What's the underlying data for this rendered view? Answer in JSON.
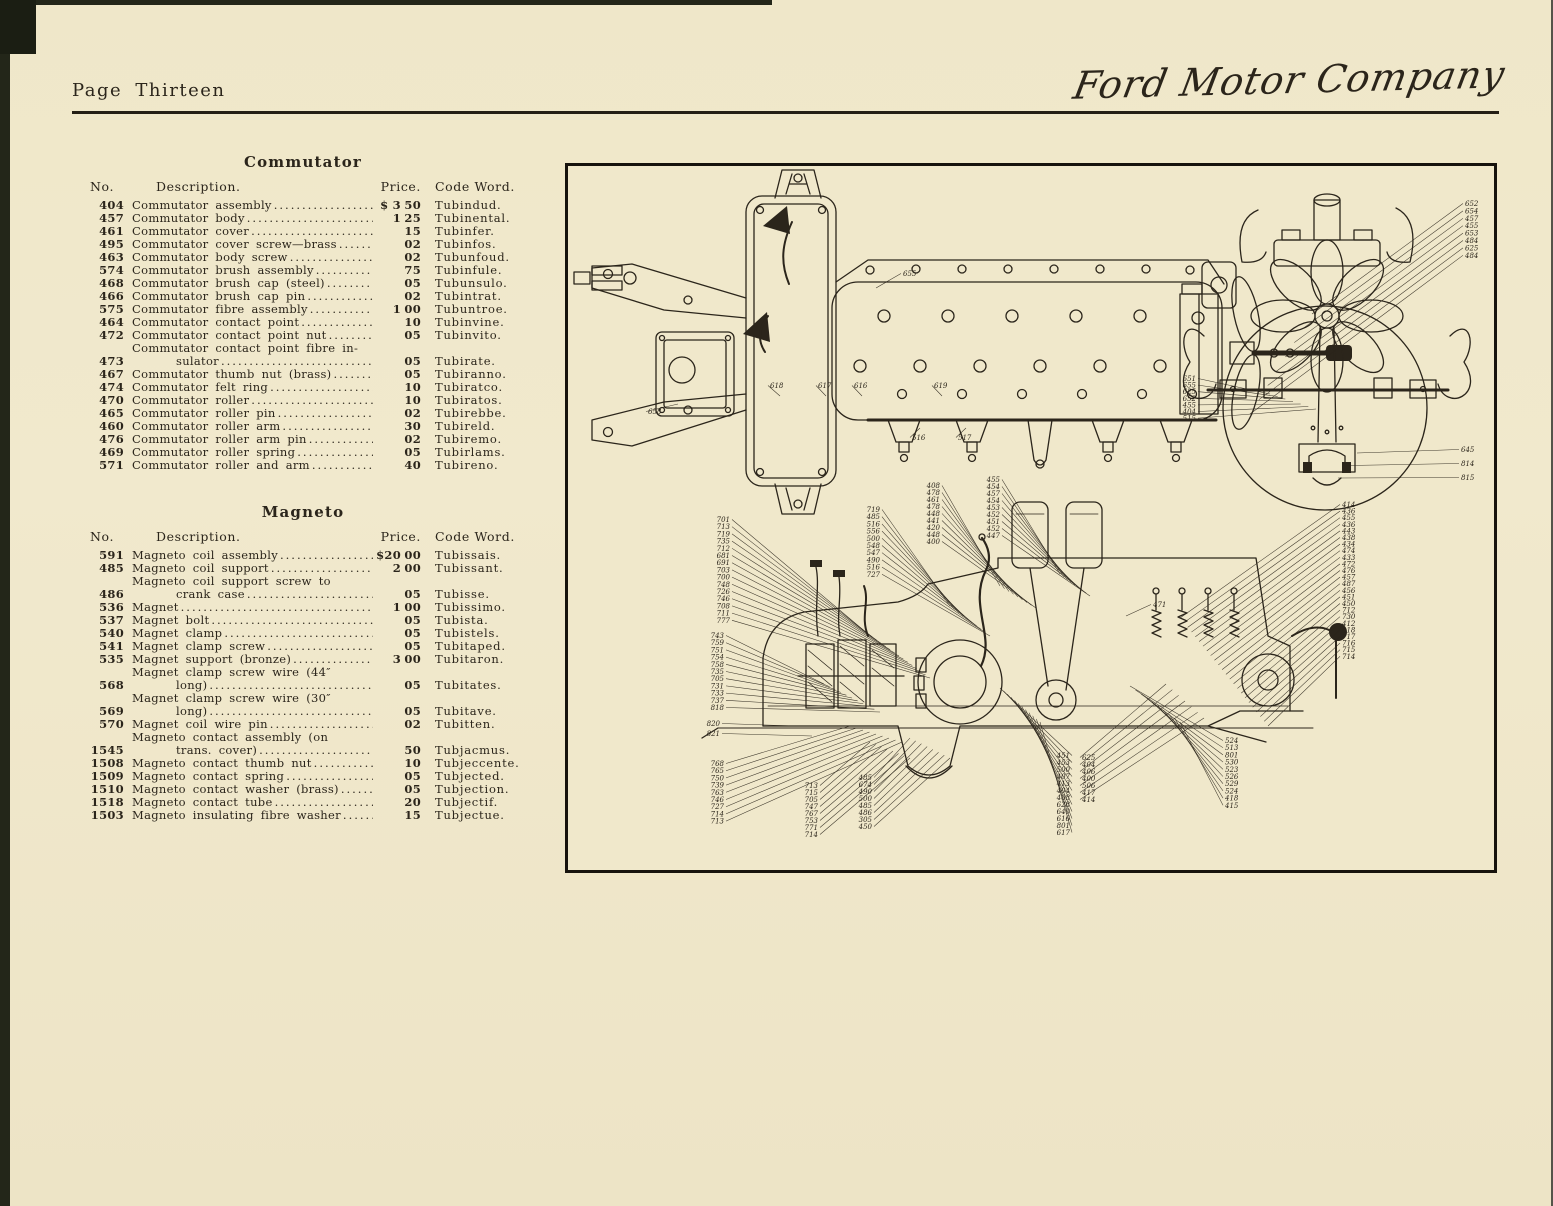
{
  "page": {
    "label": "Page Thirteen",
    "brand": "Ford Motor Company"
  },
  "commutator": {
    "title": "Commutator",
    "columns": {
      "no": "No.",
      "desc": "Description.",
      "price": "Price.",
      "code": "Code Word."
    },
    "rows": [
      {
        "no": "404",
        "desc": "Commutator assembly",
        "pd": "$ 3",
        "pc": "50",
        "code": "Tubindud."
      },
      {
        "no": "457",
        "desc": "Commutator body",
        "pd": "1",
        "pc": "25",
        "code": "Tubinental."
      },
      {
        "no": "461",
        "desc": "Commutator cover",
        "pd": "",
        "pc": "15",
        "code": "Tubinfer."
      },
      {
        "no": "495",
        "desc": "Commutator cover screw—brass",
        "pd": "",
        "pc": "02",
        "code": "Tubinfos."
      },
      {
        "no": "463",
        "desc": "Commutator body screw",
        "pd": "",
        "pc": "02",
        "code": "Tubunfoud."
      },
      {
        "no": "574",
        "desc": "Commutator brush assembly",
        "pd": "",
        "pc": "75",
        "code": "Tubinfule."
      },
      {
        "no": "468",
        "desc": "Commutator brush cap (steel)",
        "pd": "",
        "pc": "05",
        "code": "Tubunsulo."
      },
      {
        "no": "466",
        "desc": "Commutator brush cap pin",
        "pd": "",
        "pc": "02",
        "code": "Tubintrat."
      },
      {
        "no": "575",
        "desc": "Commutator fibre assembly",
        "pd": "1",
        "pc": "00",
        "code": "Tubuntroe."
      },
      {
        "no": "464",
        "desc": "Commutator contact point",
        "pd": "",
        "pc": "10",
        "code": "Tubinvine."
      },
      {
        "no": "472",
        "desc": "Commutator contact point nut",
        "pd": "",
        "pc": "05",
        "code": "Tubinvito."
      },
      {
        "no": "473",
        "desc": "Commutator contact point fibre in-",
        "desc2": "sulator",
        "pd": "",
        "pc": "05",
        "code": "Tubirate."
      },
      {
        "no": "467",
        "desc": "Commutator thumb nut (brass)",
        "pd": "",
        "pc": "05",
        "code": "Tubiranno."
      },
      {
        "no": "474",
        "desc": "Commutator felt ring",
        "pd": "",
        "pc": "10",
        "code": "Tubiratco."
      },
      {
        "no": "470",
        "desc": "Commutator roller",
        "pd": "",
        "pc": "10",
        "code": "Tubiratos."
      },
      {
        "no": "465",
        "desc": "Commutator roller pin",
        "pd": "",
        "pc": "02",
        "code": "Tubirebbe."
      },
      {
        "no": "460",
        "desc": "Commutator roller arm",
        "pd": "",
        "pc": "30",
        "code": "Tubireld."
      },
      {
        "no": "476",
        "desc": "Commutator roller arm pin",
        "pd": "",
        "pc": "02",
        "code": "Tubiremo."
      },
      {
        "no": "469",
        "desc": "Commutator roller spring",
        "pd": "",
        "pc": "05",
        "code": "Tubirlams."
      },
      {
        "no": "571",
        "desc": "Commutator roller and arm",
        "pd": "",
        "pc": "40",
        "code": "Tubireno."
      }
    ]
  },
  "magneto": {
    "title": "Magneto",
    "columns": {
      "no": "No.",
      "desc": "Description.",
      "price": "Price.",
      "code": "Code Word."
    },
    "rows": [
      {
        "no": "591",
        "desc": "Magneto coil assembly",
        "pd": "$20",
        "pc": "00",
        "code": "Tubissais."
      },
      {
        "no": "485",
        "desc": "Magneto coil support",
        "pd": "2",
        "pc": "00",
        "code": "Tubissant."
      },
      {
        "no": "486",
        "desc": "Magneto coil support screw to",
        "desc2": "crank case",
        "pd": "",
        "pc": "05",
        "code": "Tubisse."
      },
      {
        "no": "536",
        "desc": "Magnet",
        "pd": "1",
        "pc": "00",
        "code": "Tubissimo."
      },
      {
        "no": "537",
        "desc": "Magnet bolt",
        "pd": "",
        "pc": "05",
        "code": "Tubista."
      },
      {
        "no": "540",
        "desc": "Magnet clamp",
        "pd": "",
        "pc": "05",
        "code": "Tubistels."
      },
      {
        "no": "541",
        "desc": "Magnet clamp screw",
        "pd": "",
        "pc": "05",
        "code": "Tubitaped."
      },
      {
        "no": "535",
        "desc": "Magnet support (bronze)",
        "pd": "3",
        "pc": "00",
        "code": "Tubitaron."
      },
      {
        "no": "568",
        "desc": "Magnet clamp screw wire (44″",
        "desc2": "long)",
        "pd": "",
        "pc": "05",
        "code": "Tubitates."
      },
      {
        "no": "569",
        "desc": "Magnet clamp screw wire (30″",
        "desc2": "long)",
        "pd": "",
        "pc": "05",
        "code": "Tubitave."
      },
      {
        "no": "570",
        "desc": "Magnet coil wire pin",
        "pd": "",
        "pc": "02",
        "code": "Tubitten."
      },
      {
        "no": "1545",
        "desc": "Magneto contact assembly (on",
        "desc2": "trans. cover)",
        "pd": "",
        "pc": "50",
        "code": "Tubjacmus."
      },
      {
        "no": "1508",
        "desc": "Magneto contact thumb nut",
        "pd": "",
        "pc": "10",
        "code": "Tubjeccente."
      },
      {
        "no": "1509",
        "desc": "Magneto contact spring",
        "pd": "",
        "pc": "05",
        "code": "Tubjected."
      },
      {
        "no": "1510",
        "desc": "Magneto contact washer (brass)",
        "pd": "",
        "pc": "05",
        "code": "Tubjection."
      },
      {
        "no": "1518",
        "desc": "Magneto contact tube",
        "pd": "",
        "pc": "20",
        "code": "Tubjectif."
      },
      {
        "no": "1503",
        "desc": "Magneto insulating fibre washer",
        "pd": "",
        "pc": "15",
        "code": "Tubjectue."
      }
    ]
  },
  "diagram": {
    "singles": [
      {
        "t": "655",
        "x": 335,
        "y": 110,
        "lx": 308,
        "ly": 122
      },
      {
        "t": "658",
        "x": 80,
        "y": 248,
        "lx": 110,
        "ly": 238
      },
      {
        "t": "618",
        "x": 202,
        "y": 222,
        "lx": 212,
        "ly": 230
      },
      {
        "t": "617",
        "x": 250,
        "y": 222,
        "lx": 258,
        "ly": 230
      },
      {
        "t": "616",
        "x": 286,
        "y": 222,
        "lx": 294,
        "ly": 230
      },
      {
        "t": "619",
        "x": 366,
        "y": 222,
        "lx": 374,
        "ly": 230
      },
      {
        "t": "516",
        "x": 344,
        "y": 274,
        "lx": 352,
        "ly": 262
      },
      {
        "t": "517",
        "x": 390,
        "y": 274,
        "lx": 398,
        "ly": 262
      },
      {
        "t": "471",
        "x": 585,
        "y": 441,
        "lx": 558,
        "ly": 450
      }
    ],
    "clusters": [
      {
        "name": "front-right-labels",
        "x": 897,
        "y0": 40,
        "dy": 7.4,
        "anchor": "start",
        "items": [
          "652",
          "654",
          "457",
          "455",
          "653",
          "484",
          "625",
          "484"
        ],
        "fan": [
          744,
          148,
          682,
          248
        ]
      },
      {
        "name": "front-left-labels",
        "x": 628,
        "y0": 215,
        "dy": 6.6,
        "anchor": "end",
        "items": [
          "651",
          "655",
          "625",
          "652",
          "455",
          "404",
          "515"
        ],
        "fan": [
          702,
          228,
          748,
          243
        ]
      },
      {
        "name": "front-bottom-labels",
        "x": 893,
        "y0": 286,
        "dy": 14,
        "anchor": "start",
        "items": [
          "645",
          "814",
          "815"
        ],
        "fan": [
          789,
          287,
          770,
          312
        ]
      },
      {
        "name": "right-column-labels",
        "x": 774,
        "y0": 341,
        "dy": 6.6,
        "fs": 6.2,
        "anchor": "start",
        "items": [
          "414",
          "436",
          "455",
          "436",
          "443",
          "438",
          "434",
          "474",
          "433",
          "472",
          "476",
          "457",
          "487",
          "456",
          "451",
          "450",
          "712",
          "730",
          "412",
          "418",
          "717",
          "716",
          "715",
          "714"
        ],
        "fan": [
          612,
          452,
          700,
          560
        ]
      },
      {
        "name": "left-upper-labels",
        "x": 162,
        "y0": 356,
        "dy": 7.2,
        "anchor": "end",
        "items": [
          "701",
          "713",
          "719",
          "735",
          "712",
          "681",
          "691",
          "703",
          "700",
          "748",
          "726",
          "746",
          "708",
          "711",
          "777"
        ],
        "fan": [
          300,
          468,
          362,
          512
        ]
      },
      {
        "name": "left-mid-labels",
        "x": 156,
        "y0": 472,
        "dy": 7.2,
        "anchor": "end",
        "items": [
          "743",
          "759",
          "751",
          "754",
          "758",
          "735",
          "705",
          "731",
          "733",
          "737",
          "818"
        ],
        "fan": [
          256,
          518,
          312,
          546
        ]
      },
      {
        "name": "left-pan-labels",
        "x": 152,
        "y0": 560,
        "dy": 10,
        "anchor": "end",
        "items": [
          "820",
          "821"
        ],
        "fan": [
          228,
          560,
          244,
          570
        ]
      },
      {
        "name": "left-lower-labels",
        "x": 156,
        "y0": 600,
        "dy": 7.2,
        "anchor": "end",
        "items": [
          "768",
          "765",
          "750",
          "739",
          "763",
          "746",
          "727",
          "714",
          "713"
        ],
        "fan": [
          282,
          560,
          334,
          576
        ]
      },
      {
        "name": "center-stack-labels",
        "x": 312,
        "y0": 346,
        "dy": 7.2,
        "anchor": "end",
        "items": [
          "719",
          "485",
          "516",
          "556",
          "500",
          "548",
          "547",
          "490",
          "516",
          "727"
        ],
        "fan": [
          382,
          440,
          422,
          470
        ]
      },
      {
        "name": "center-upper-labels",
        "x": 372,
        "y0": 322,
        "dy": 7,
        "anchor": "end",
        "items": [
          "408",
          "478",
          "461",
          "478",
          "448",
          "441",
          "420",
          "448",
          "400"
        ],
        "fan": [
          432,
          420,
          468,
          442
        ]
      },
      {
        "name": "center-upper2-labels",
        "x": 432,
        "y0": 316,
        "dy": 7,
        "anchor": "end",
        "items": [
          "455",
          "454",
          "457",
          "454",
          "453",
          "452",
          "451",
          "452",
          "447"
        ],
        "fan": [
          492,
          408,
          522,
          430
        ]
      },
      {
        "name": "right-lower-labels",
        "x": 657,
        "y0": 577,
        "dy": 7.2,
        "anchor": "start",
        "items": [
          "524",
          "513",
          "801",
          "530",
          "523",
          "526",
          "529",
          "524",
          "418",
          "415"
        ],
        "fan": [
          562,
          520,
          612,
          556
        ]
      },
      {
        "name": "bottom-left-labels",
        "x": 250,
        "y0": 622,
        "dy": 7,
        "anchor": "end",
        "items": [
          "713",
          "715",
          "705",
          "747",
          "767",
          "753",
          "771",
          "714"
        ],
        "fan": [
          302,
          576,
          342,
          592
        ]
      },
      {
        "name": "bottom-left2-labels",
        "x": 304,
        "y0": 614,
        "dy": 7,
        "anchor": "end",
        "items": [
          "485",
          "674",
          "490",
          "500",
          "485",
          "486",
          "305",
          "450"
        ],
        "fan": [
          342,
          572,
          382,
          592
        ]
      },
      {
        "name": "bottom-center-labels",
        "x": 502,
        "y0": 592,
        "dy": 7,
        "anchor": "end",
        "items": [
          "451",
          "453",
          "500",
          "407",
          "413",
          "404",
          "408",
          "628",
          "640",
          "616",
          "801",
          "617"
        ],
        "fan": [
          432,
          522,
          472,
          556
        ]
      },
      {
        "name": "bottom-right-labels",
        "x": 514,
        "y0": 594,
        "dy": 7,
        "anchor": "start",
        "items": [
          "625",
          "404",
          "406",
          "400",
          "506",
          "417",
          "414"
        ],
        "fan": [
          598,
          518,
          636,
          552
        ]
      }
    ]
  }
}
